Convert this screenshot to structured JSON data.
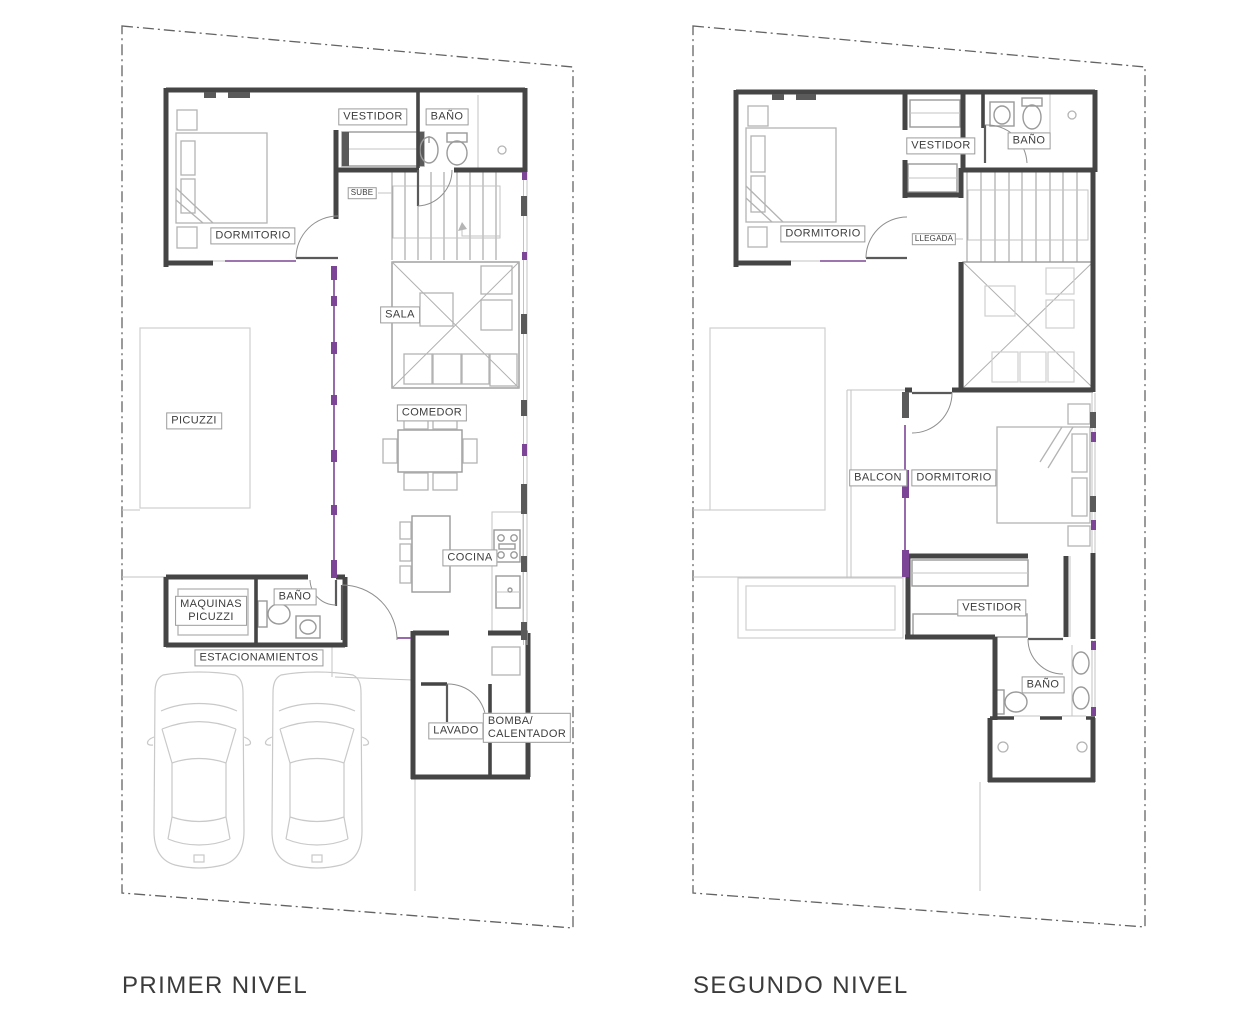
{
  "drawing": {
    "levels": [
      {
        "title": "PRIMER NIVEL",
        "rooms": [
          "VESTIDOR",
          "BAÑO",
          "SUBE",
          "DORMITORIO",
          "SALA",
          "PICUZZI",
          "COMEDOR",
          "COCINA",
          "MAQUINAS\nPICUZZI",
          "BAÑO",
          "ESTACIONAMIENTOS",
          "LAVADO",
          "BOMBA/\nCALENTADOR"
        ]
      },
      {
        "title": "SEGUNDO NIVEL",
        "rooms": [
          "VESTIDOR",
          "BAÑO",
          "DORMITORIO",
          "LLEGADA",
          "BALCON",
          "DORMITORIO",
          "VESTIDOR",
          "BAÑO"
        ]
      }
    ],
    "colors": {
      "wall": "#454545",
      "furniture": "#b3b3b3",
      "ghost_outline": "#cfcfcf",
      "window_accent": "#7d4596",
      "lot_boundary": "#636363"
    }
  }
}
